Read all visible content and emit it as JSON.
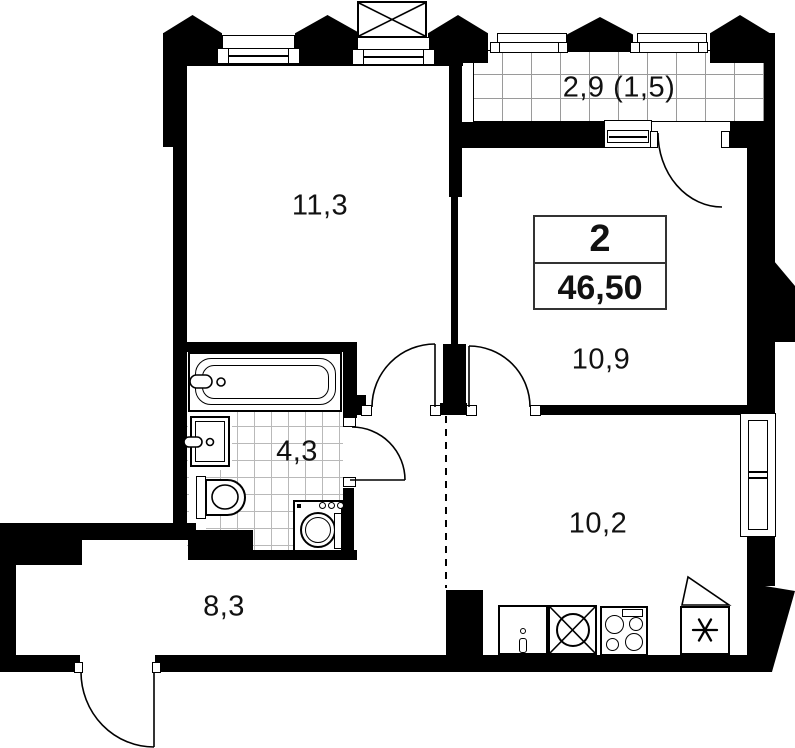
{
  "floorplan": {
    "title_block": {
      "rooms_count": "2",
      "total_area": "46,50"
    },
    "rooms": [
      {
        "key": "living-room",
        "label": "11,3"
      },
      {
        "key": "balcony",
        "label": "2,9 (1,5)"
      },
      {
        "key": "bedroom",
        "label": "10,9"
      },
      {
        "key": "bathroom",
        "label": "4,3"
      },
      {
        "key": "kitchen",
        "label": "10,2"
      },
      {
        "key": "hallway",
        "label": "8,3"
      }
    ],
    "fixtures": [
      "bathtub",
      "wash-basin",
      "toilet",
      "washing-machine",
      "kitchen-counter",
      "kitchen-sink",
      "stove",
      "refrigerator",
      "air-conditioner-box"
    ],
    "colors": {
      "wall": "#000000",
      "background": "#ffffff",
      "tile_line": "#b9b9b9",
      "balcony_grid_line": "#9a9a9a"
    }
  }
}
